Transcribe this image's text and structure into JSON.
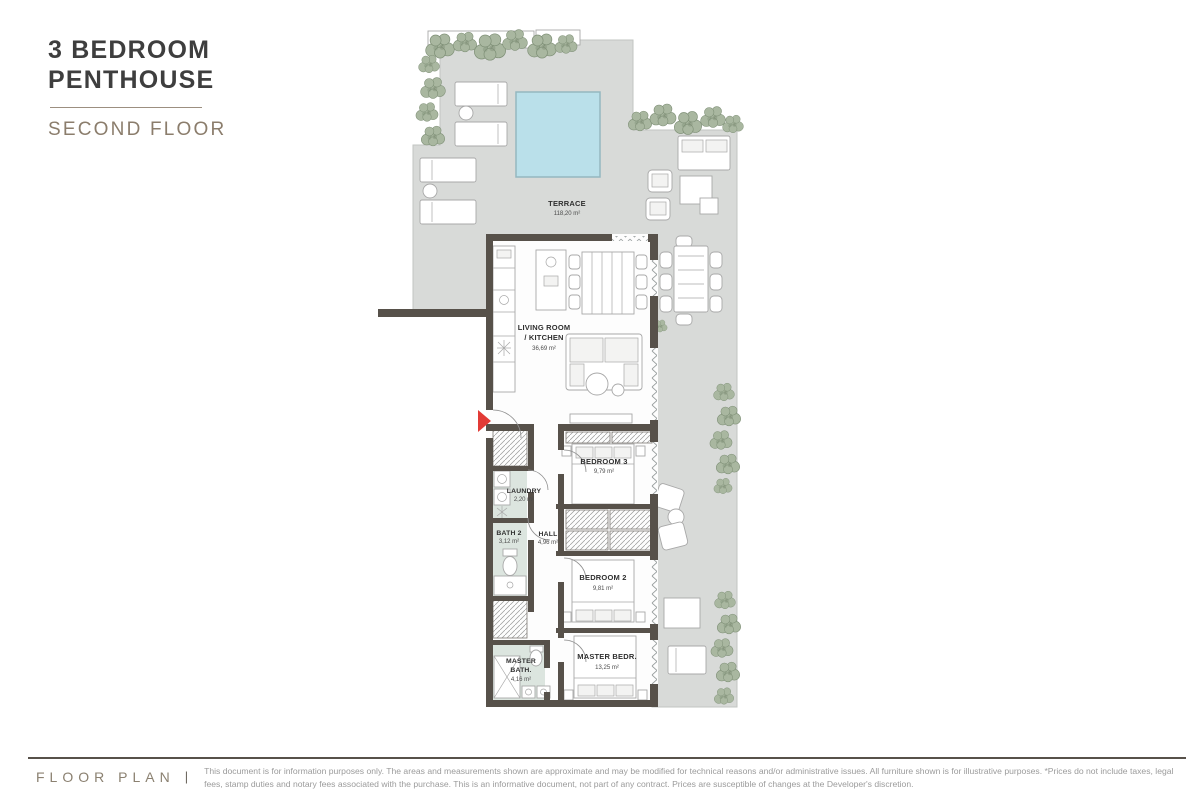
{
  "header": {
    "title_line1": "3 BEDROOM",
    "title_line2": "PENTHOUSE",
    "subtitle": "SECOND FLOOR"
  },
  "plan": {
    "terrace": {
      "label": "TERRACE",
      "area": "118,20 m²"
    },
    "living": {
      "label_line1": "LIVING ROOM",
      "label_line2": "/ KITCHEN",
      "area": "36,69 m²"
    },
    "bedroom3": {
      "label": "BEDROOM 3",
      "area": "9,79 m²"
    },
    "laundry": {
      "label": "LAUNDRY",
      "area": "2,20 m²"
    },
    "bath2": {
      "label": "BATH 2",
      "area": "3,12 m²"
    },
    "hall": {
      "label": "HALL",
      "area": "4,96 m²"
    },
    "bedroom2": {
      "label": "BEDROOM 2",
      "area": "9,81 m²"
    },
    "master_bath": {
      "label_line1": "MASTER",
      "label_line2": "BATH.",
      "area": "4,16 m²"
    },
    "master_bedroom": {
      "label": "MASTER BEDR.",
      "area": "13,25 m²"
    }
  },
  "footer": {
    "label": "FLOOR PLAN",
    "separator": "|",
    "disclaimer": "This document is for information purposes only. The areas and measurements shown are approximate and may be modified for technical reasons and/or administrative issues. All furniture shown is for illustrative purposes. *Prices do not include taxes, legal fees, stamp duties and notary fees associated with the purchase. This is an informative document, not part of any contract. Prices are susceptible of changes at the Developer's discretion."
  },
  "colors": {
    "wall": "#57514a",
    "terrace": "#d8dad8",
    "pool": "#bae0ea",
    "pool_edge": "#94b7c0",
    "tile": "#dce5df",
    "plant": "#a9b7a0",
    "plant_edge": "#7e8f76",
    "line": "#a8a8a8",
    "accent": "#e23b36",
    "title": "#3e3e3e",
    "taupe": "#8b7d6c",
    "text_gray": "#9b9b9b"
  }
}
